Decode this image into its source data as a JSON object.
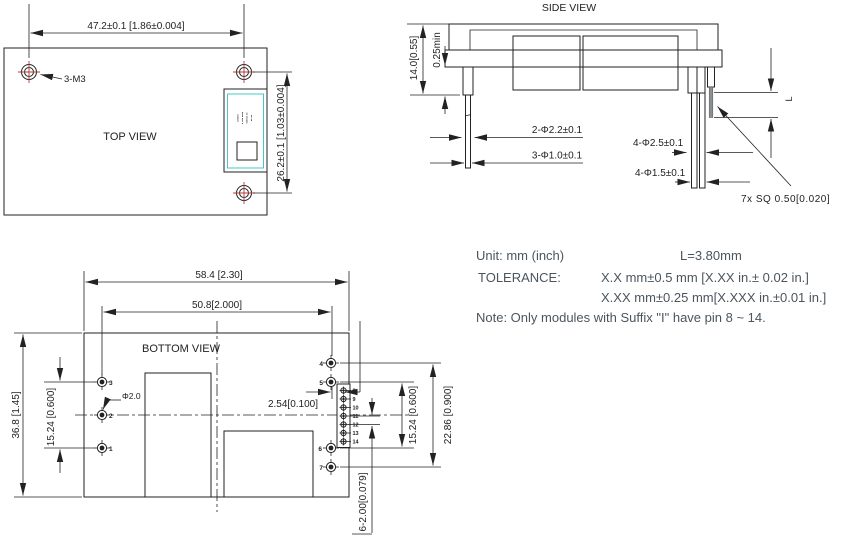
{
  "top_view": {
    "title": "TOP VIEW",
    "dim_width": "47.2±0.1 [1.86±0.004]",
    "dim_height": "26.2±0.1 [1.03±0.004]",
    "screw_label": "3-M3",
    "label_lines": [
      "▪▪▪▪▪▪",
      "▪ ▪▪▪ ▪▪▪▪",
      "▪▪▪▪▪▪ ▪▪",
      "▪▪ ▪▪"
    ]
  },
  "side_view": {
    "title": "SIDE VIEW",
    "dim_height": "14.0[0.55]",
    "dim_clearance": "0.25min",
    "dim_left_shoulder": "2-Φ2.2±0.1",
    "dim_left_pin": "3-Φ1.0±0.1",
    "dim_right_shoulder": "4-Φ2.5±0.1",
    "dim_right_pin": "4-Φ1.5±0.1",
    "dim_square_pin": "7x SQ 0.50[0.020]",
    "pin_length_label": "L"
  },
  "bottom_view": {
    "title": "BOTTOM VIEW",
    "dim_width_overall": "58.4 [2.30]",
    "dim_pin_span": "50.8[2.000]",
    "dim_height_overall": "36.8 [1.45]",
    "dim_left_pin_span": "15.24 [0.600]",
    "dim_pin_dia": "Φ2.0",
    "dim_pitch": "2.54[0.100]",
    "dim_right_pin_span": "15.24 [0.600]",
    "dim_right_outer_span": "22.86 [0.900]",
    "dim_header_pitch": "6-2.00[0.079]",
    "left_pins": [
      "3",
      "2",
      "1"
    ],
    "right_pins": [
      "4",
      "5",
      "6",
      "7"
    ],
    "header_pins": [
      "8",
      "9",
      "10",
      "11",
      "12",
      "13",
      "14"
    ]
  },
  "notes": {
    "unit": "Unit: mm (inch)",
    "l_value": "L=3.80mm",
    "tolerance_label": "TOLERANCE:",
    "tolerance_line1": "X.X mm±0.5 mm [X.XX in.± 0.02 in.]",
    "tolerance_line2": "X.XX mm±0.25 mm[X.XXX in.±0.01 in.]",
    "note": "Note: Only modules with Suffix \"I\" have pin 8 ~ 14."
  },
  "colors": {
    "line": "#222222",
    "crosshair_red": "#b23b3b",
    "label_cyan": "#45c7c9",
    "note_text": "#4b555e",
    "pin_gray": "#8a9093"
  }
}
